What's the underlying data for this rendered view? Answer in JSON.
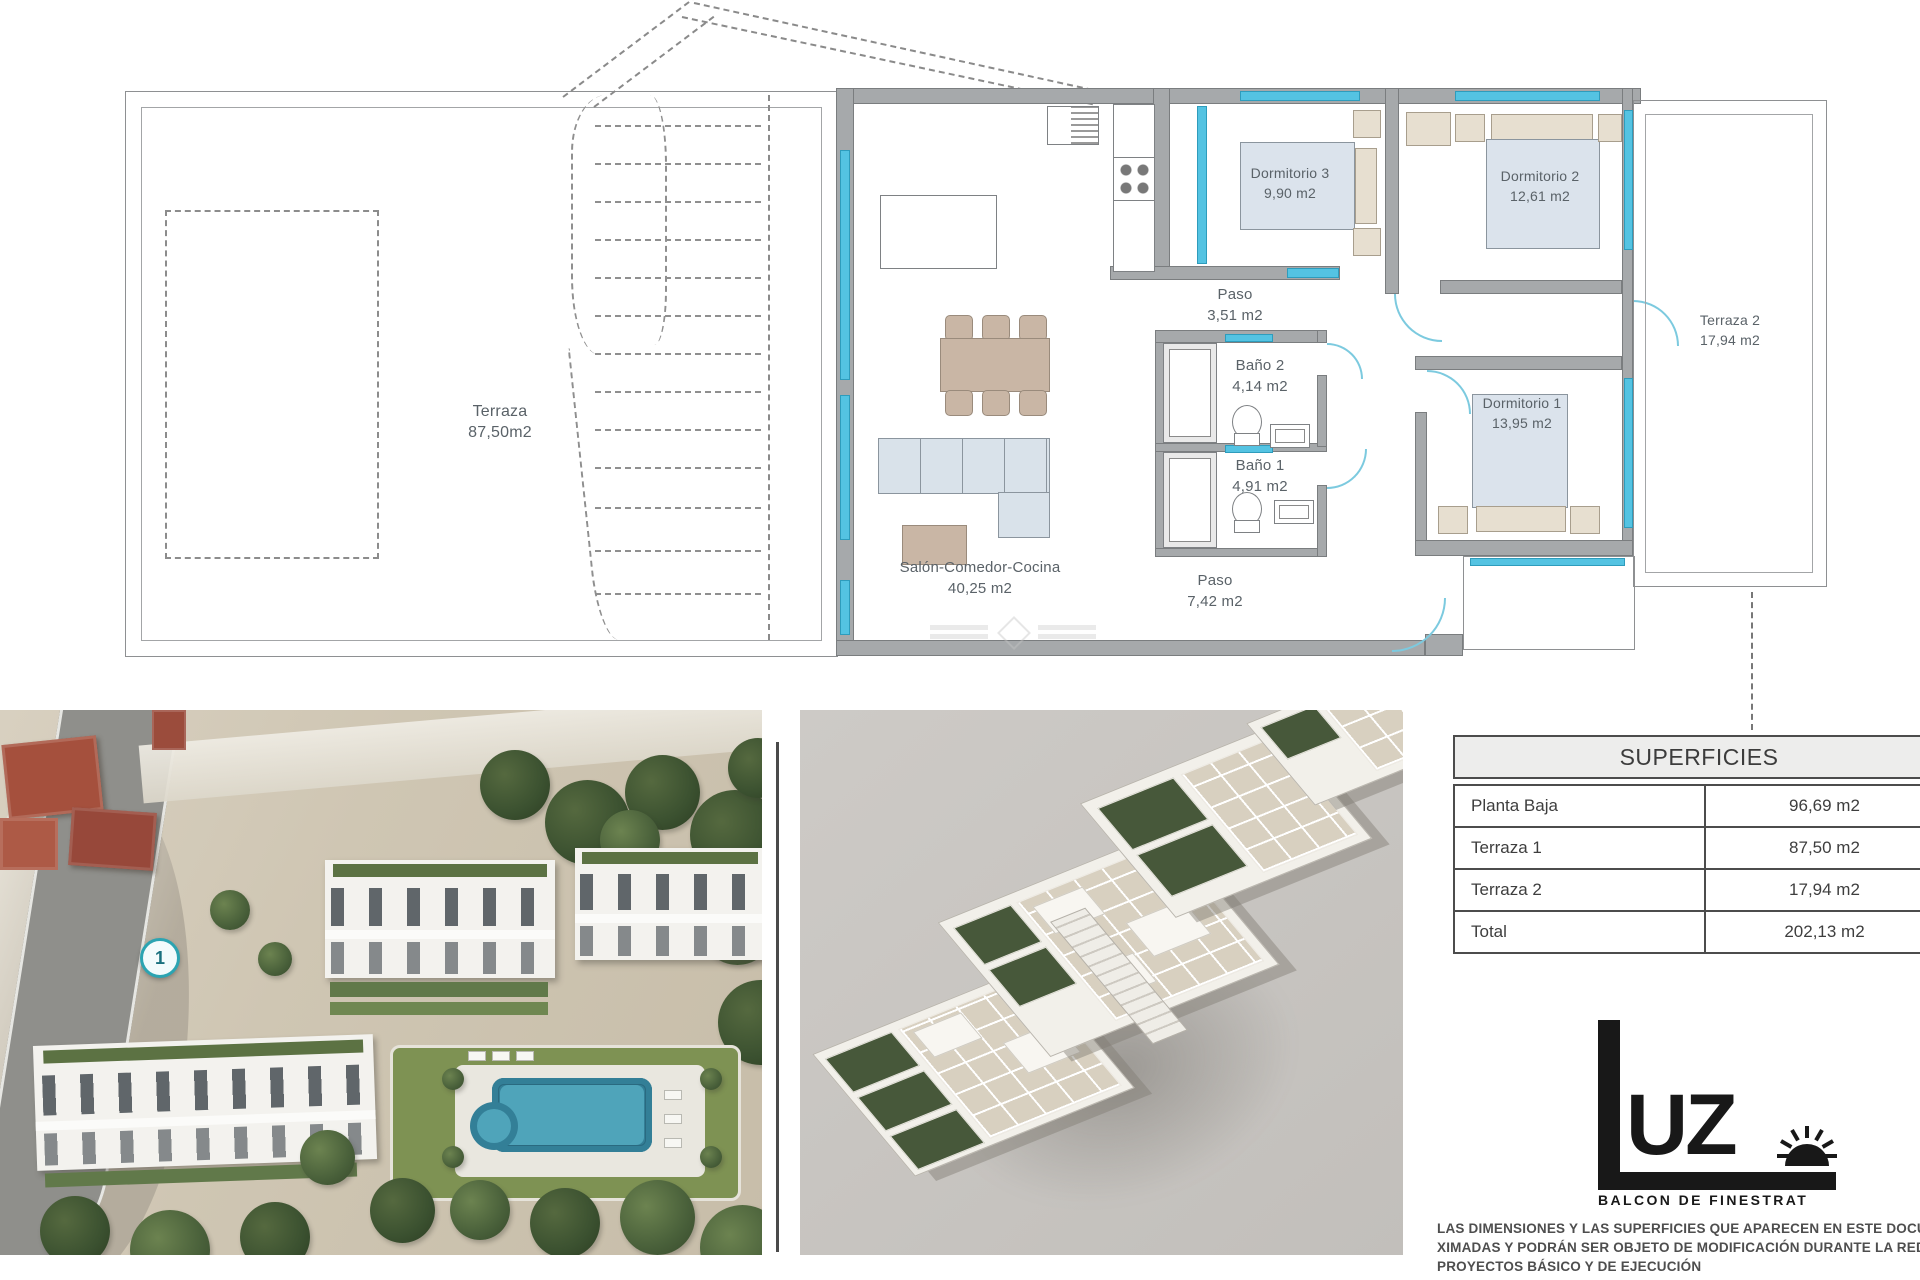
{
  "plan": {
    "terraza1": {
      "name": "Terraza",
      "area": "87,50m2"
    },
    "terraza2": {
      "name": "Terraza 2",
      "area": "17,94 m2"
    },
    "salon": {
      "name": "Salón-Comedor-Cocina",
      "area": "40,25 m2"
    },
    "paso_a": {
      "name": "Paso",
      "area": "3,51 m2"
    },
    "paso_b": {
      "name": "Paso",
      "area": "7,42 m2"
    },
    "bano1": {
      "name": "Baño 1",
      "area": "4,91 m2"
    },
    "bano2": {
      "name": "Baño 2",
      "area": "4,14 m2"
    },
    "dorm1": {
      "name": "Dormitorio 1",
      "area": "13,95 m2"
    },
    "dorm2": {
      "name": "Dormitorio 2",
      "area": "12,61 m2"
    },
    "dorm3": {
      "name": "Dormitorio 3",
      "area": "9,90 m2"
    }
  },
  "photo": {
    "badge": "1"
  },
  "table": {
    "title": "SUPERFICIES",
    "rows": [
      {
        "label": "Planta Baja",
        "value": "96,69 m2"
      },
      {
        "label": "Terraza 1",
        "value": "87,50 m2"
      },
      {
        "label": "Terraza 2",
        "value": "17,94 m2"
      },
      {
        "label": "Total",
        "value": "202,13 m2"
      }
    ]
  },
  "logo": {
    "uz": "UZ",
    "subtitle": "BALCON DE FINESTRAT"
  },
  "disclaimer": {
    "line1": "LAS DIMENSIONES Y LAS SUPERFICIES QUE APARECEN EN ESTE DOCUMENTO",
    "line2": "XIMADAS Y PODRÁN SER OBJETO DE MODIFICACIÓN DURANTE LA REDAC",
    "line3": "PROYECTOS BÁSICO Y DE EJECUCIÓN"
  },
  "colors": {
    "window": "#54c3e2",
    "wall": "#a6a9ab",
    "badge_teal": "#2ba4b2",
    "logo_black": "#181818"
  }
}
